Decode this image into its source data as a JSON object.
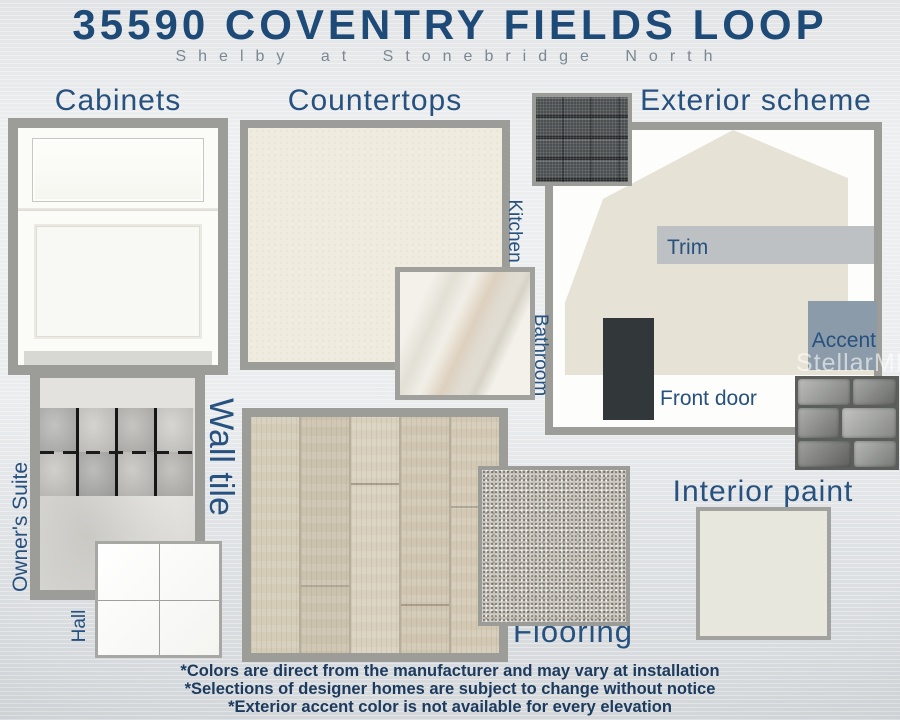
{
  "header": {
    "title": "35590 COVENTRY FIELDS LOOP",
    "subtitle": "Shelby at Stonebridge North"
  },
  "sections": {
    "cabinets": {
      "label": "Cabinets"
    },
    "countertops": {
      "label": "Countertops",
      "kitchen": "Kitchen",
      "bathroom": "Bathroom"
    },
    "exterior_scheme": {
      "label": "Exterior scheme",
      "trim": "Trim",
      "front_door": "Front door",
      "accent": "Accent"
    },
    "wall_tile": {
      "label": "Wall tile",
      "owners_suite": "Owner's Suite",
      "hall": "Hall"
    },
    "flooring": {
      "label": "Flooring"
    },
    "interior_paint": {
      "label": "Interior paint"
    }
  },
  "watermark": "StellarMLS",
  "disclaimers": [
    "*Colors are direct from the manufacturer and may vary at installation",
    "*Selections of designer homes are subject to change without notice",
    "*Exterior accent color is not available for every elevation"
  ],
  "colors": {
    "title_navy": "#1e4a78",
    "label_navy": "#27517e",
    "subtitle_gray": "#7b8894",
    "frame_gray": "#9c9c98",
    "cabinet_white": "#fbfbf7",
    "kitchen_countertop_cream": "#efecdf",
    "house_siding_beige": "#e6e3d6",
    "trim_gray": "#bdc1c4",
    "front_door_charcoal": "#32373a",
    "accent_blue_gray": "#8c9ba9",
    "roof_shingle_dark": "#4b4f51",
    "interior_paint_greige": "#e8e7de",
    "disclaimer_navy": "#1c3a5d"
  }
}
